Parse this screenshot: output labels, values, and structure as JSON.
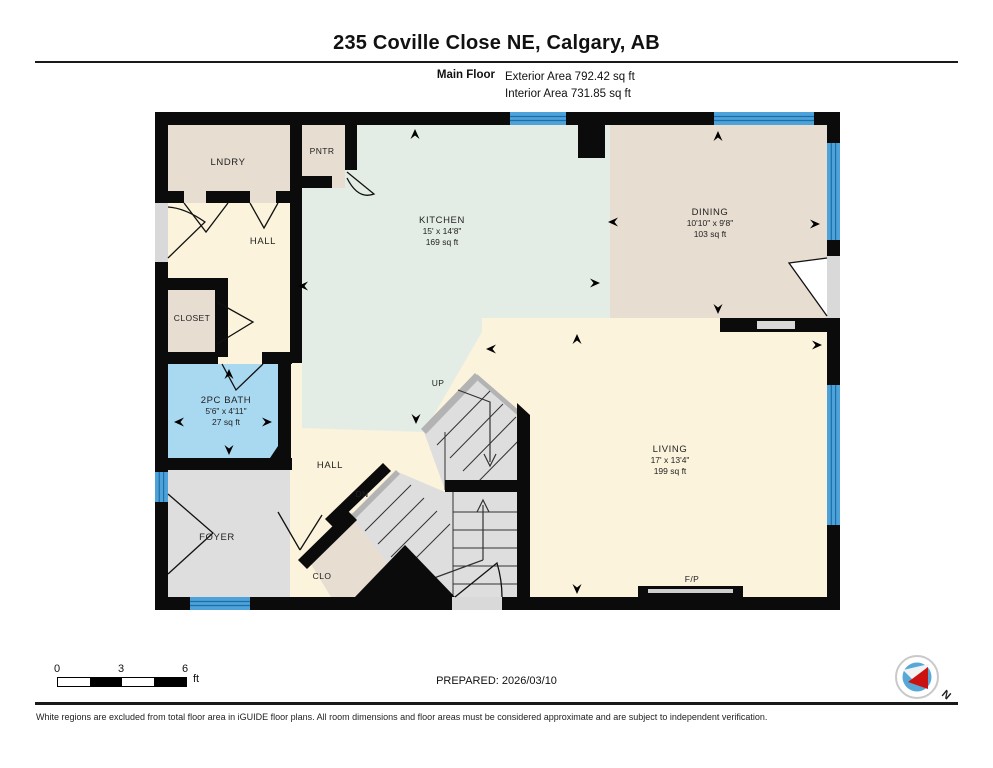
{
  "header": {
    "title": "235 Coville Close NE, Calgary, AB",
    "floor_label": "Main Floor",
    "exterior_area": "Exterior Area 792.42 sq ft",
    "interior_area": "Interior Area 731.85 sq ft"
  },
  "rooms": {
    "laundry": {
      "name": "LNDRY"
    },
    "pantry": {
      "name": "PNTR"
    },
    "hall_upper": {
      "name": "HALL"
    },
    "closet": {
      "name": "CLOSET"
    },
    "bath": {
      "name": "2PC BATH",
      "dims": "5'6\" x 4'11\"",
      "area": "27 sq ft"
    },
    "kitchen": {
      "name": "KITCHEN",
      "dims": "15' x 14'8\"",
      "area": "169 sq ft"
    },
    "dining": {
      "name": "DINING",
      "dims": "10'10\" x 9'8\"",
      "area": "103 sq ft"
    },
    "living": {
      "name": "LIVING",
      "dims": "17' x 13'4\"",
      "area": "199 sq ft"
    },
    "foyer": {
      "name": "FOYER"
    },
    "hall_lower": {
      "name": "HALL"
    },
    "closet_lower": {
      "name": "CLO"
    },
    "stairs_up": {
      "label": "UP"
    },
    "stairs_down": {
      "label": "DN"
    },
    "fireplace": {
      "label": "F/P"
    }
  },
  "scale_bar": {
    "ticks": [
      "0",
      "3",
      "6"
    ],
    "unit": "ft"
  },
  "compass": {
    "label": "N"
  },
  "footer": {
    "prepared": "PREPARED: 2026/03/10",
    "disclaimer": "White regions are excluded from total floor area in iGUIDE floor plans. All room dimensions and floor areas must be considered approximate and are subject to independent verification."
  },
  "colors": {
    "wall": "#0b0b0b",
    "window": "#4da3d9",
    "bath": "#a9d9f1",
    "kitchen": "#e3ede6",
    "room_beige": "#e7ddd0",
    "room_cream": "#fbf3dc",
    "gray": "#dedede"
  }
}
